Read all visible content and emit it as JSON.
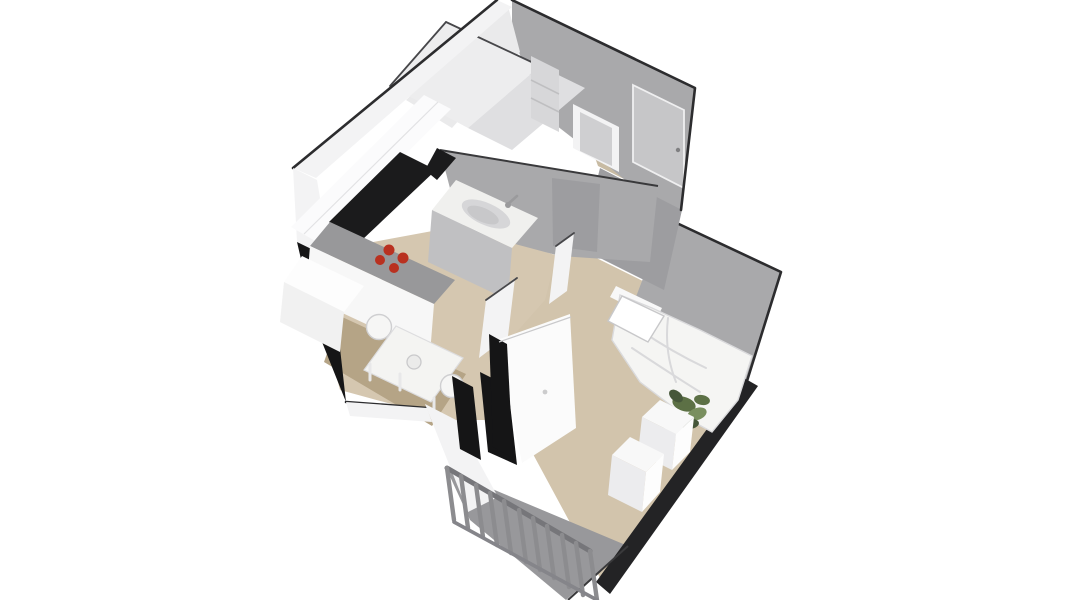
{
  "scene": {
    "type": "isometric-3d-floor-plan",
    "subject": "3D rendered floor plan of a one-bedroom apartment, viewed from above at an angle on a white background",
    "rooms": [
      "bathroom",
      "entrance-hall",
      "kitchen-living-room",
      "bedroom",
      "balcony"
    ],
    "furniture": [
      "upper-kitchen-cabinets",
      "kitchen-counter-with-stove",
      "kitchen-sink",
      "dining-table",
      "dining-chairs",
      "shelf-unit",
      "entry-door",
      "bathroom-door",
      "wardrobe",
      "double-bed",
      "pillow",
      "plant",
      "dresser",
      "balcony-railing"
    ]
  },
  "colors": {
    "background": "#ffffff",
    "wall_gray": "#a9a9ab",
    "wall_gray_dark": "#9d9da0",
    "wall_white": "#f3f3f4",
    "wall_white_bright": "#fbfbfc",
    "bath_interior": "#eaeaeb",
    "partition_white": "#ededee",
    "partition_shadow": "#dfdfe1",
    "cut_black": "#151516",
    "niche_black": "#1b1b1c",
    "outline_dark": "#2c2c2e",
    "wood_floor": "#d5c7b0",
    "wood_floor_bedroom": "#d2c4ac",
    "wood_floor_dining": "#b5a486",
    "hall_floor": "#c8bba3",
    "balcony_floor": "#98989b",
    "counter_top_gray": "#98989a",
    "counter_front_white": "#f7f7f7",
    "counter_front_shadow": "#c0c0c2",
    "counter_white_box": "#fdfdfd",
    "counter_box_front": "#f1f1f1",
    "burner_red": "#b93120",
    "door_panel_gray": "#c6c6c8",
    "glass_gray": "#cfcfd1",
    "shelf_gray": "#d7d7d9",
    "sink_top": "#f0f0ee",
    "sink_basin": "#d6d6d8",
    "sink_basin_inner": "#c8c8ca",
    "furniture_white": "#f8f8f8",
    "furniture_white_dim": "#ececee",
    "furniture_side": "#fdfdfd",
    "wardrobe_white": "#fbfbfb",
    "wardrobe_top": "#f0f0f1",
    "duvet_white": "#f5f5f3",
    "pillow_white": "#ffffff",
    "headboard_white": "#f8f8f8",
    "dark_band": "#232325",
    "plant_green": "#5c7045",
    "plant_green_light": "#798f5e",
    "plant_green_dark": "#46573a",
    "pot_white": "#f0f0ef",
    "table_white": "#f4f4f2",
    "chair_white": "#f6f6f5",
    "vase_white": "#ebebea"
  }
}
